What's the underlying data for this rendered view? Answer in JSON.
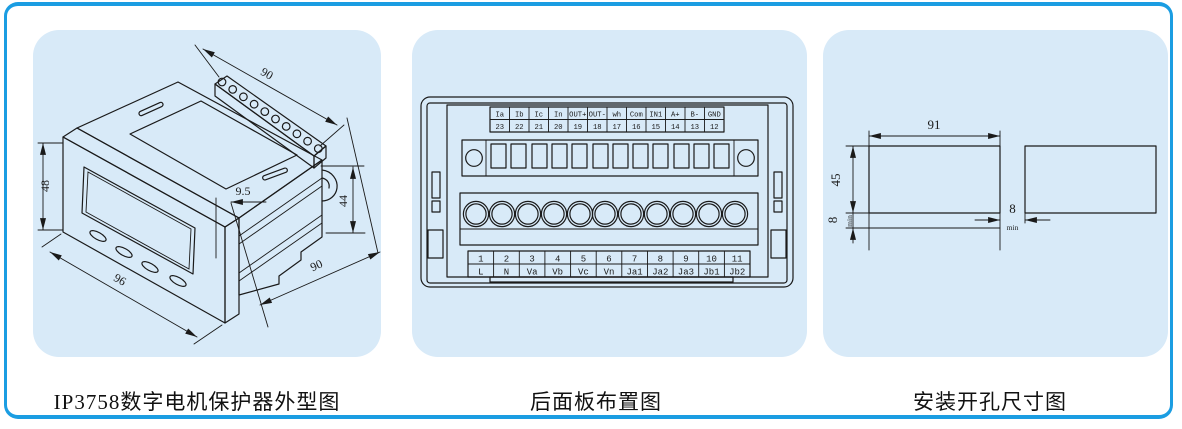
{
  "frame": {
    "border_color": "#1b9de2",
    "panel_color": "#d8eaf8",
    "line_color": "#1a1a1a"
  },
  "panel1": {
    "caption": "IP3758数字电机保护器外型图",
    "dims": {
      "top_depth": "90",
      "front_height": "48",
      "bezel_depth": "9.5",
      "body_height": "44",
      "front_width": "96",
      "bottom_depth": "90"
    }
  },
  "panel2": {
    "caption": "后面板布置图",
    "top_labels": [
      "Ia",
      "Ib",
      "Ic",
      "In",
      "OUT+",
      "OUT-",
      "wh",
      "Com",
      "IN1",
      "A+",
      "B-",
      "GND"
    ],
    "top_numbers": [
      "23",
      "22",
      "21",
      "20",
      "19",
      "18",
      "17",
      "16",
      "15",
      "14",
      "13",
      "12"
    ],
    "bottom_numbers": [
      "1",
      "2",
      "3",
      "4",
      "5",
      "6",
      "7",
      "8",
      "9",
      "10",
      "11"
    ],
    "bottom_labels": [
      "L",
      "N",
      "Va",
      "Vb",
      "Vc",
      "Vn",
      "Ja1",
      "Ja2",
      "Ja3",
      "Jb1",
      "Jb2"
    ]
  },
  "panel3": {
    "caption": "安装开孔尺寸图",
    "dims": {
      "width": "91",
      "height": "45",
      "v_gap": "8",
      "v_gap_note": "min",
      "h_gap": "8",
      "h_gap_note": "min"
    }
  }
}
